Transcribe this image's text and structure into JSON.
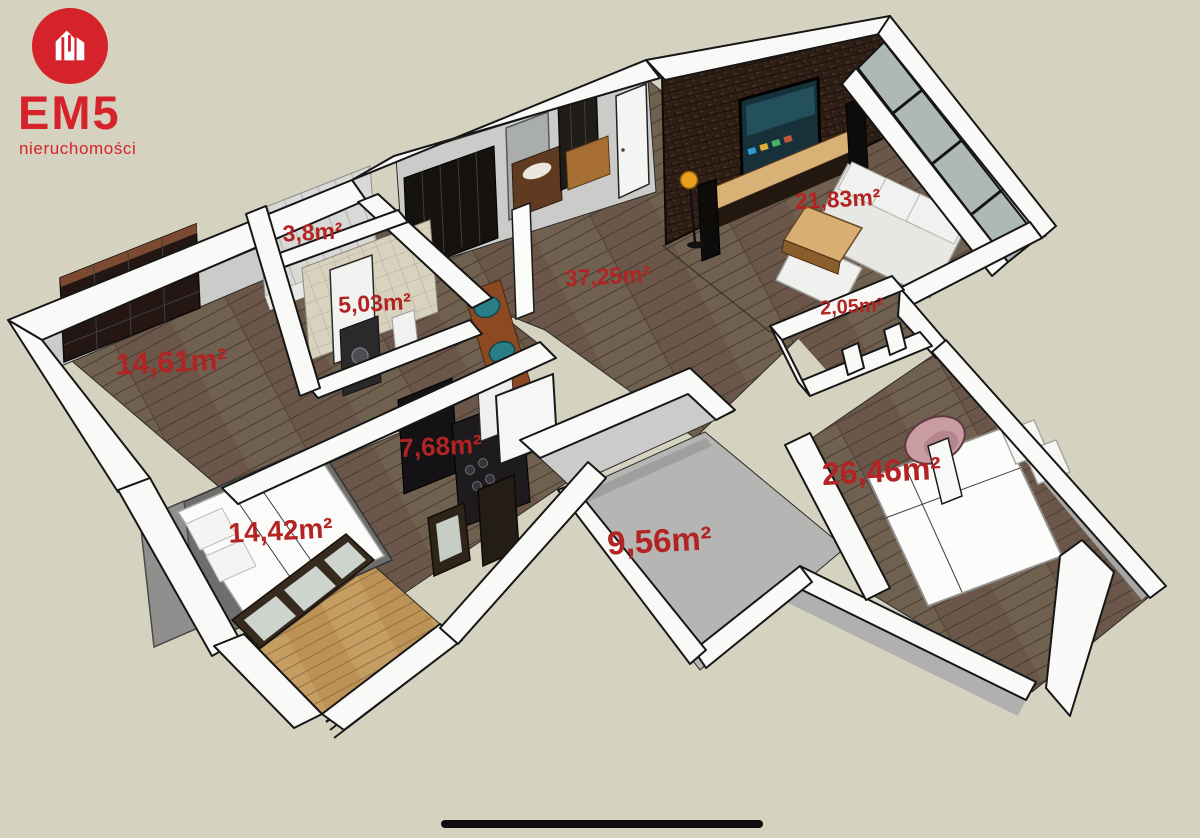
{
  "page": {
    "background_color": "#d5d2c0",
    "kind": "3d floor plan render"
  },
  "logo": {
    "brand": "EM5",
    "subtitle": "nieruchomości",
    "color": "#d6232b",
    "icon": "house-icon"
  },
  "floor_plan": {
    "label_color": "#b22423",
    "area_unit": "m²",
    "rooms": [
      {
        "name": "wardrobe",
        "area_label": "3,8m²"
      },
      {
        "name": "bathroom",
        "area_label": "5,03m²"
      },
      {
        "name": "hall-living",
        "area_label": "37,25m²"
      },
      {
        "name": "living-room",
        "area_label": "21,83m²"
      },
      {
        "name": "corridor",
        "area_label": "2,05m²"
      },
      {
        "name": "room",
        "area_label": "14,61m²"
      },
      {
        "name": "kitchen",
        "area_label": "7,68m²"
      },
      {
        "name": "bedroom",
        "area_label": "14,42m²"
      },
      {
        "name": "utility-room",
        "area_label": "9,56m²"
      },
      {
        "name": "master-bedroom",
        "area_label": "26,46m²"
      }
    ]
  },
  "home_indicator": {
    "visible": true
  }
}
